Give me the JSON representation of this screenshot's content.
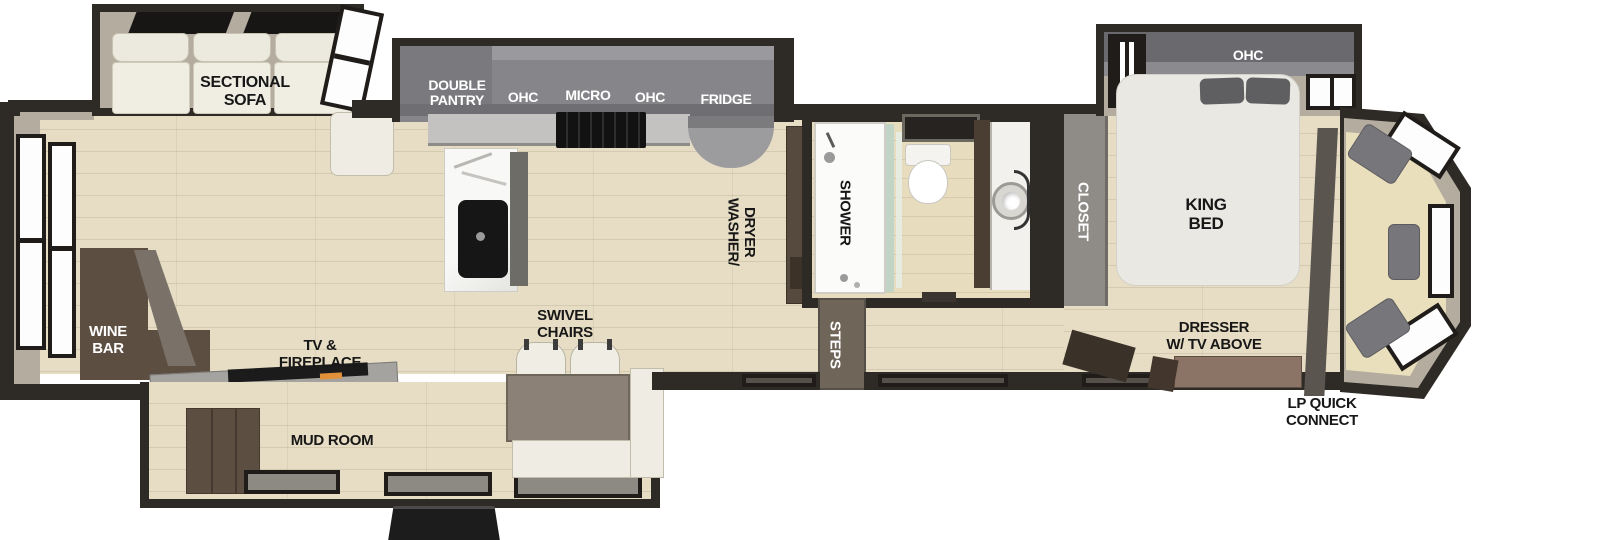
{
  "title": "RV fifth-wheel floor plan",
  "colors": {
    "background": "#ffffff",
    "wall_dark": "#2e2a26",
    "wall_light": "#b3ac9f",
    "floor_wood": "#e7ddc5",
    "floor_bath": "#e8dcbe",
    "carpet": "#e9dfbc",
    "cabinet_gray": "#86868a",
    "counter_gray": "#c3c2c0",
    "furniture_white": "#efece3",
    "brown_dark": "#5d4e42",
    "bed_white": "#e9e8e2",
    "pillow_gray": "#5f5f62",
    "glass_green": "#c2d4c6",
    "steps_gray": "#6f6559",
    "label_black": "#171717",
    "label_white": "#ffffff",
    "ember_orange": "#e0913a"
  },
  "labels": {
    "sectional_sofa": [
      "SECTIONAL",
      "SOFA"
    ],
    "wine_bar": [
      "WINE",
      "BAR"
    ],
    "tv_fireplace": [
      "TV &",
      "FIREPLACE"
    ],
    "mud_room": "MUD ROOM",
    "swivel_chairs": [
      "SWIVEL",
      "CHAIRS"
    ],
    "double_pantry": [
      "DOUBLE",
      "PANTRY"
    ],
    "ohc_left": "OHC",
    "micro": "MICRO",
    "ohc_right": "OHC",
    "fridge": "FRIDGE",
    "washer_dryer": [
      "WASHER/",
      "DRYER"
    ],
    "shower": "SHOWER",
    "steps": "STEPS",
    "closet": "CLOSET",
    "bedroom_ohc": "OHC",
    "king_bed": [
      "KING",
      "BED"
    ],
    "dresser_tv": [
      "DRESSER",
      "W/ TV ABOVE"
    ],
    "lp_quick_connect": [
      "LP QUICK",
      "CONNECT"
    ]
  }
}
